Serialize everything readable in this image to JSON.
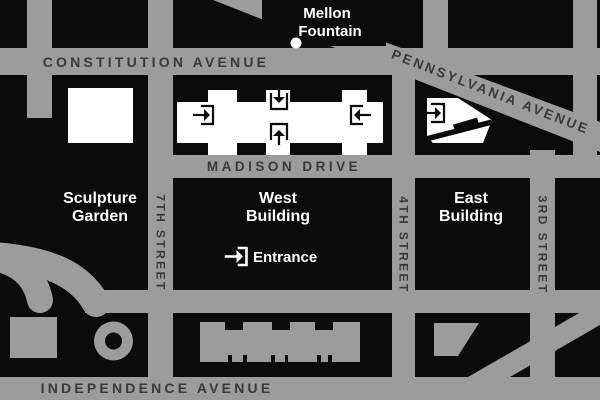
{
  "map": {
    "title": "National Gallery of Art area street map",
    "labels": {
      "constitution": "CONSTITUTION AVENUE",
      "madison": "MADISON DRIVE",
      "independence": "INDEPENDENCE AVENUE",
      "pennsylvania": "PENNSYLVANIA AVENUE",
      "seventh_street": "7TH STREET",
      "fourth_street": "4TH STREET",
      "third_street": "3RD STREET",
      "mellon_line1": "Mellon",
      "mellon_line2": "Fountain",
      "sculpture_line1": "Sculpture",
      "sculpture_line2": "Garden",
      "west_line1": "West",
      "west_line2": "Building",
      "east_line1": "East",
      "east_line2": "Building",
      "entrance": "Entrance"
    },
    "icons": {
      "entrance_icon": "arrow-into-bracket",
      "fountain_dot": "white-circle"
    },
    "colors": {
      "street": "#9c9c9c",
      "block": "#0c0b0c",
      "street_label": "#3b373b",
      "building_white": "#ffffff",
      "label_white": "#ffffff"
    }
  }
}
